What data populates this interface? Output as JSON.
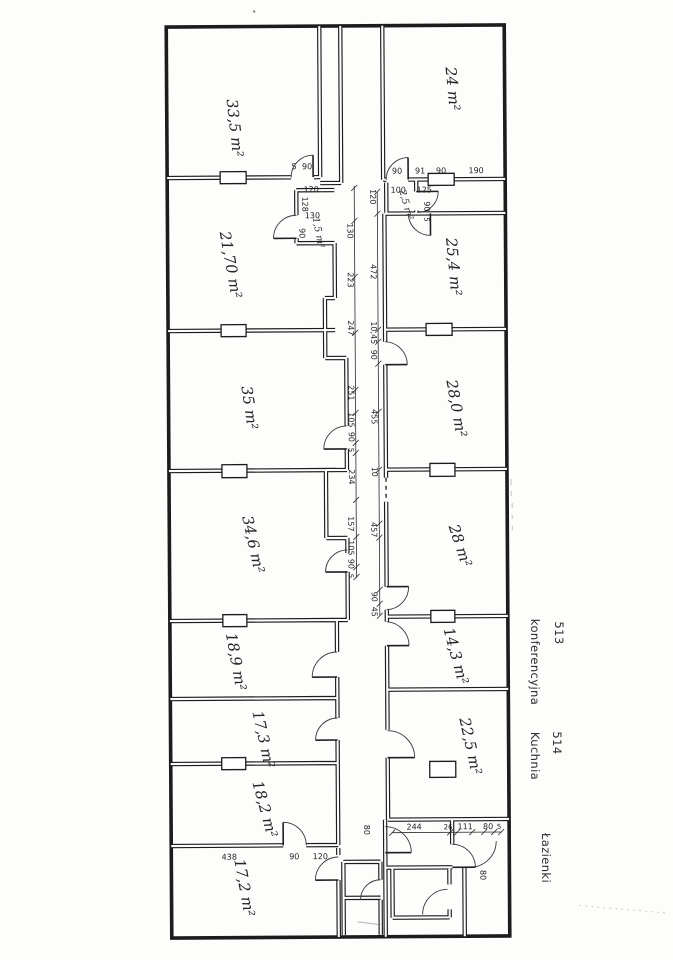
{
  "plan": {
    "ink_color": "#1f1f1f",
    "paper_color": "#fdfdfc",
    "rooms_left": [
      "33,5 m²",
      "21,70 m²",
      "35 m²",
      "34,6 m²",
      "18,9 m²",
      "17,3 m²",
      "18,2 m²",
      "17,2 m²"
    ],
    "rooms_right": [
      "24 m²",
      "25,4 m²",
      "28,0 m²",
      "28 m²",
      "14,3 m²",
      "22,5 m²"
    ],
    "rooms_small": [
      "1,5 m²",
      "2,5 m²"
    ],
    "dims": {
      "corridor_left": [
        "130",
        "223",
        "247",
        "251",
        "105",
        "90",
        "5",
        "234",
        "157",
        "105",
        "90",
        "5"
      ],
      "corridor_right": [
        "120",
        "472",
        "10,45",
        "90",
        "455",
        "10",
        "457",
        "90",
        "45"
      ],
      "top_left": [
        "5",
        "90",
        "120",
        "128",
        "130",
        "90"
      ],
      "top_right": [
        "90",
        "91",
        "90",
        "190",
        "100",
        "125",
        "90",
        "5"
      ],
      "bottom_left": [
        "438",
        "90",
        "120"
      ],
      "bottom_right": [
        "244",
        "26",
        "111",
        "80",
        "5"
      ],
      "doors": [
        "80",
        "80"
      ]
    }
  },
  "annotations": [
    {
      "number": "513",
      "name": "konferencyjna"
    },
    {
      "number": "514",
      "name": "Kuchnia"
    },
    {
      "number": "",
      "name": "Łazienki"
    }
  ]
}
